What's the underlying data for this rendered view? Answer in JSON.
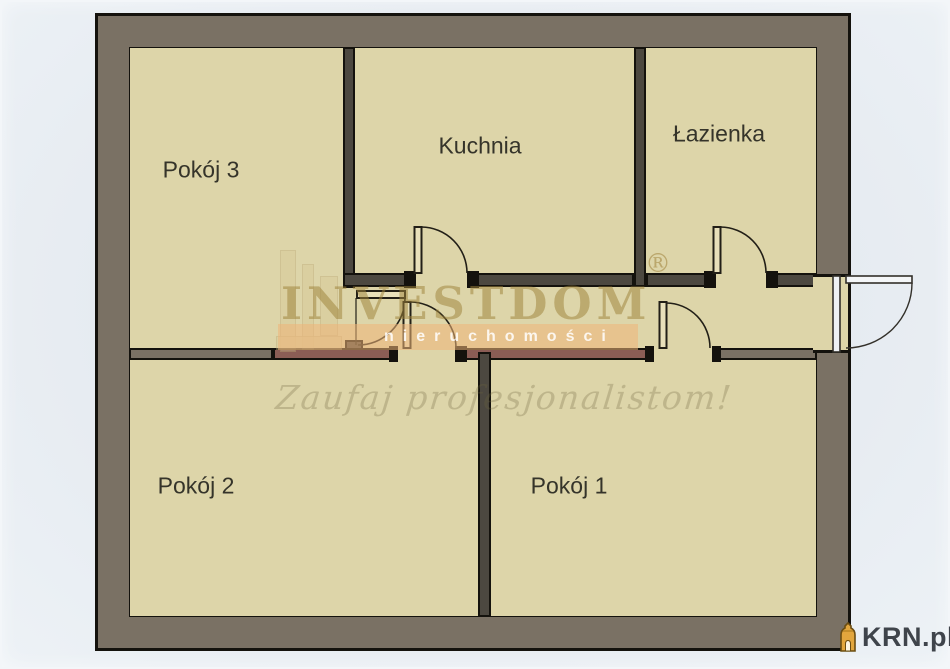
{
  "floorplan": {
    "rooms": [
      {
        "name": "pokoj-3",
        "label": "Pokój 3"
      },
      {
        "name": "kuchnia",
        "label": "Kuchnia"
      },
      {
        "name": "lazienka",
        "label": "Łazienka"
      },
      {
        "name": "pokoj-2",
        "label": "Pokój 2"
      },
      {
        "name": "pokoj-1",
        "label": "Pokój 1"
      }
    ],
    "doors": [
      "kitchen-door",
      "bathroom-door",
      "pokoj-3-door",
      "pokoj-2-door",
      "pokoj-1-door",
      "entrance-door"
    ],
    "colors": {
      "background": "#e8edf3",
      "floor": "#ddd5a9",
      "outer_wall": "#7a7164",
      "inner_wall": "#4c4840",
      "accent_wall": "#8b5d55",
      "outline": "#14120d"
    }
  },
  "watermark": {
    "brand": "INVESTDOM",
    "registered_mark": "®",
    "subtitle": "nieruchomości",
    "tagline": "Zaufaj profesjonalistom!",
    "band_color": "#eeb478"
  },
  "branding": {
    "site": "KRN.pl",
    "icon": "lighthouse-icon",
    "icon_color": "#e2a63d",
    "text_color": "#3f444b"
  }
}
